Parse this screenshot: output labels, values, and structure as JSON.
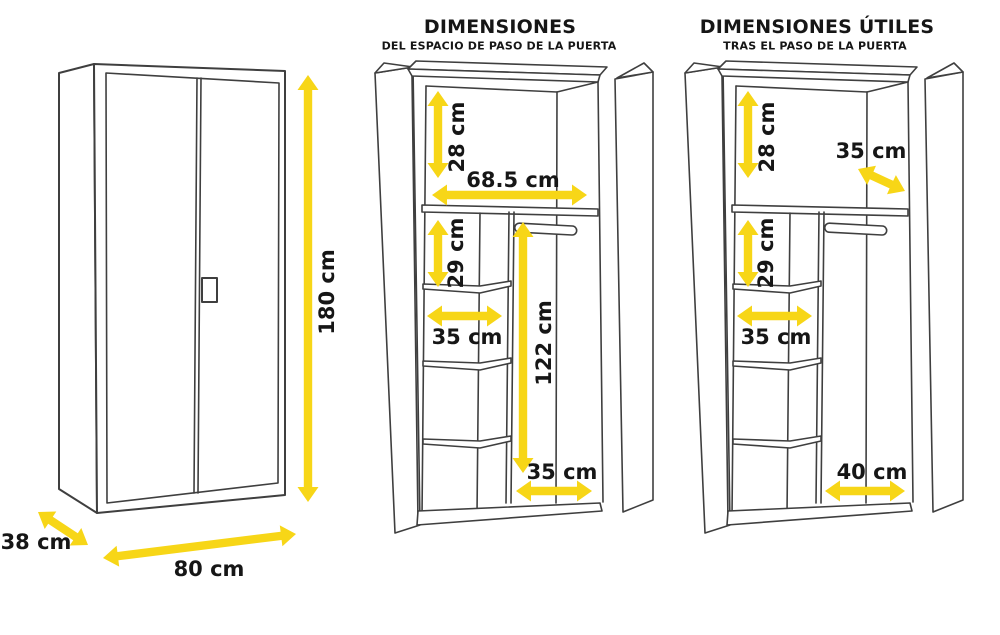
{
  "colors": {
    "arrow_yellow": "#F7D617",
    "line_gray": "#3f3f3f",
    "text_black": "#161616"
  },
  "panels": {
    "closed": {
      "labels": {
        "height": "180 cm",
        "width": "80 cm",
        "depth": "38 cm"
      }
    },
    "door_pass": {
      "title": "DIMENSIONES",
      "subtitle": "DEL ESPACIO DE PASO DE LA PUERTA",
      "labels": {
        "top_compartment_height": "28 cm",
        "interior_width": "68.5 cm",
        "upper_shelf_height": "29 cm",
        "shelf_column_width": "35 cm",
        "hanging_area_height": "122 cm",
        "hanging_area_width": "35 cm"
      }
    },
    "useful": {
      "title": "DIMENSIONES ÚTILES",
      "subtitle": "TRAS EL PASO DE LA PUERTA",
      "labels": {
        "top_compartment_height": "28 cm",
        "top_compartment_depth": "35 cm",
        "upper_shelf_height": "29 cm",
        "shelf_column_width": "35 cm",
        "hanging_area_width": "40 cm"
      }
    }
  }
}
